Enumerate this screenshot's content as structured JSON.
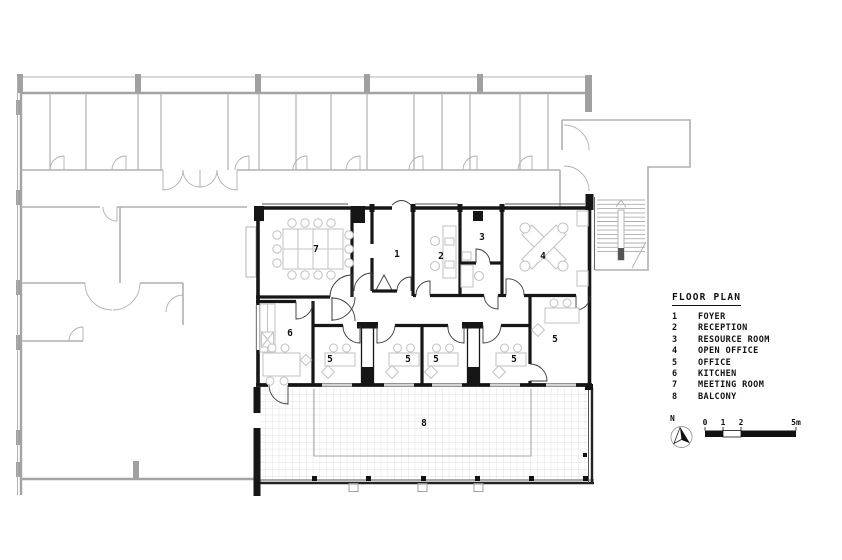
{
  "legend": {
    "title": "FLOOR PLAN",
    "items": [
      {
        "num": "1",
        "label": "FOYER"
      },
      {
        "num": "2",
        "label": "RECEPTION"
      },
      {
        "num": "3",
        "label": "RESOURCE ROOM"
      },
      {
        "num": "4",
        "label": "OPEN OFFICE"
      },
      {
        "num": "5",
        "label": "OFFICE"
      },
      {
        "num": "6",
        "label": "KITCHEN"
      },
      {
        "num": "7",
        "label": "MEETING ROOM"
      },
      {
        "num": "8",
        "label": "BALCONY"
      }
    ]
  },
  "plan": {
    "room_labels": [
      {
        "text": "7"
      },
      {
        "text": "1"
      },
      {
        "text": "2"
      },
      {
        "text": "3"
      },
      {
        "text": "4"
      },
      {
        "text": "6"
      },
      {
        "text": "5"
      },
      {
        "text": "5"
      },
      {
        "text": "5"
      },
      {
        "text": "5"
      },
      {
        "text": "5"
      },
      {
        "text": "8"
      }
    ]
  },
  "compass": {
    "label": "N"
  },
  "scale_bar": {
    "labels": [
      "0",
      "1",
      "2",
      "5m"
    ]
  },
  "colors": {
    "wall_black": "#161616",
    "context_gray": "#b0b0b0",
    "furniture_gray": "#c5c5c5",
    "tile_grid": "#d6d6d6"
  }
}
